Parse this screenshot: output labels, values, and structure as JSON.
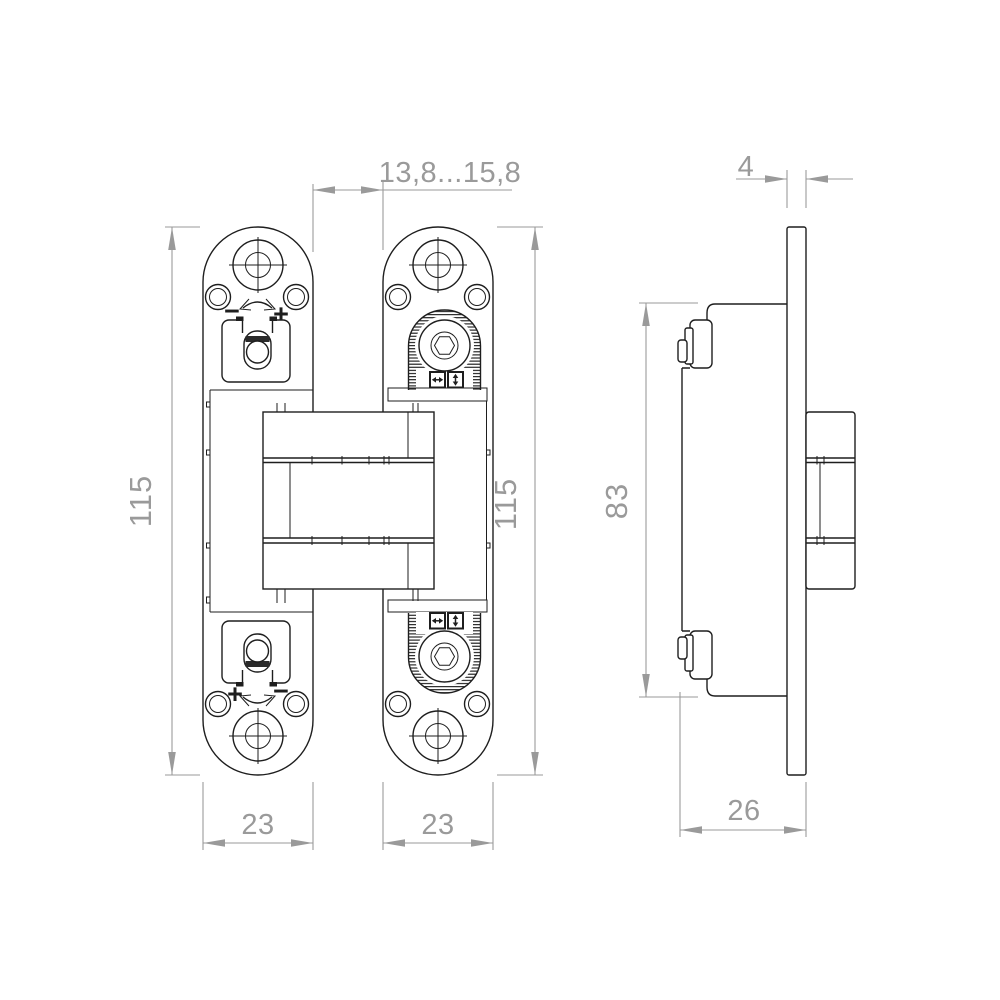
{
  "drawing": {
    "type": "technical-drawing",
    "subject": "concealed door hinge - front view and side view",
    "background_color": "#ffffff",
    "geometry_line_color": "#1e1e1e",
    "dimension_color": "#9a9a9a",
    "dimensions": {
      "gap": {
        "label": "13,8...15,8"
      },
      "plate_thickness": {
        "label": "4"
      },
      "height_left": {
        "label": "115"
      },
      "height_right": {
        "label": "115"
      },
      "body_height": {
        "label": "83"
      },
      "plate_width_left": {
        "label": "23"
      },
      "plate_width_right": {
        "label": "23"
      },
      "depth": {
        "label": "26"
      }
    },
    "adjustment_signs": {
      "top_minus": "−",
      "top_plus": "+",
      "bottom_plus": "+",
      "bottom_minus": "−"
    },
    "icons": {
      "horizontal_adjust": "horizontal-double-arrow",
      "vertical_adjust": "vertical-double-arrow",
      "rotation_adjust": "curved-double-arrow"
    }
  }
}
